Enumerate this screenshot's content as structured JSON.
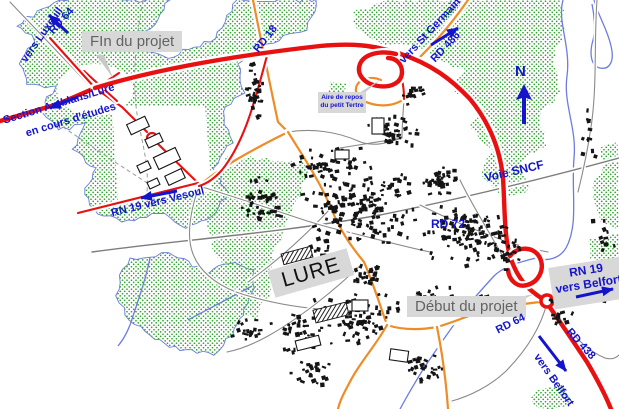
{
  "colors": {
    "forest_green": "#2ba12b",
    "forest_outline_blue": "#6b7fd6",
    "river_blue": "#6e7ce0",
    "road_red": "#e81111",
    "road_orange": "#ee8c28",
    "road_gray": "#8a8a8a",
    "railway_gray": "#7d7d7d",
    "boundary_gray": "#9a9a9a",
    "building_black": "#151515",
    "label_blue": "#1414cc",
    "callout_bg": "#d8d8d8",
    "callout_pointer": "#c9c9c9",
    "callout_text": "#636363",
    "lure_text": "#111111"
  },
  "labels": {
    "rd64_northwest": "RD 64",
    "vers_luxeuil": "vers Luxeuil",
    "fin_du_projet": "FIn du projet",
    "section_amblans_lure": "Section Amblans/Lure",
    "en_cours_detudes": "en cours d'études",
    "rd18": "RD 18",
    "vers_st_germain": "vers St Germain",
    "rd486": "RD 486",
    "aire_de_repos_line1": "Aire de repos",
    "aire_de_repos_line2": "du petit Tertre",
    "voie_sncf": "Voie SNCF",
    "rd72": "RD 72",
    "rn19_vers_vesoul": "RN 19 vers Vesoul",
    "lure": "LURE",
    "debut_du_projet": "Début du projet",
    "rn19_belfort_line1": "RN 19",
    "rn19_belfort_line2": "vers Belfort",
    "rd64_southeast": "RD 64",
    "rd438": "RD 438",
    "vers_belfort": "vers Belfort",
    "north": "N"
  }
}
